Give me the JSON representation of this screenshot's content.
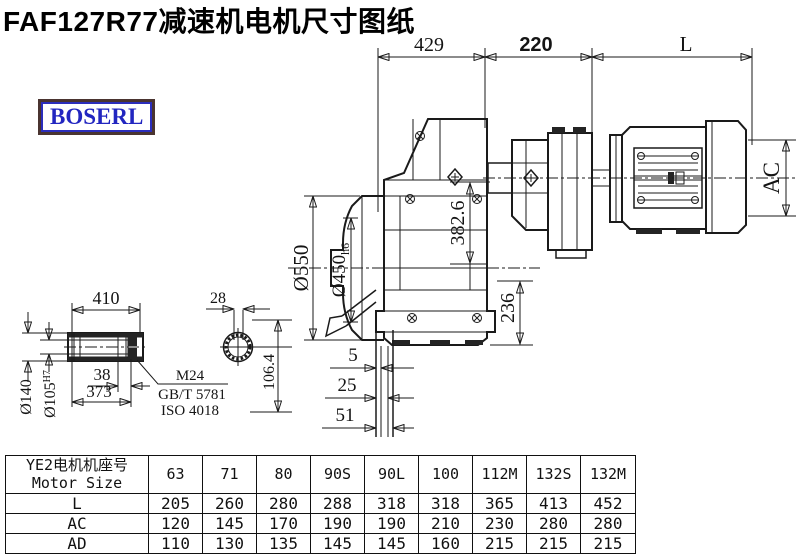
{
  "title": "FAF127R77减速机电机尺寸图纸",
  "brand": "BOSERL",
  "colors": {
    "line": "#1a1a1a",
    "brand_text": "#2226c0",
    "brand_border": "#4a3430"
  },
  "dims": {
    "top429": "429",
    "top220": "220",
    "topL": "L",
    "dia550": "Ø550",
    "dia450": "Ø450",
    "dia450_tol": "h6",
    "v382": "382.6",
    "v236": "236",
    "ac": "AC",
    "s5": "5",
    "s25": "25",
    "s51": "51",
    "shaft410": "410",
    "dia140": "Ø140",
    "dia105": "Ø105",
    "dia105_tol": "H7",
    "k38": "38",
    "k373": "373",
    "thread": "M24",
    "std_gb": "GB/T 5781",
    "std_iso": "ISO 4018",
    "c28": "28",
    "c106": "106.4"
  },
  "table": {
    "header_line1": "YE2电机机座号",
    "header_line2": "Motor Size",
    "columns": [
      "63",
      "71",
      "80",
      "90S",
      "90L",
      "100",
      "112M",
      "132S",
      "132M"
    ],
    "rows": [
      {
        "label": "L",
        "values": [
          "205",
          "260",
          "280",
          "288",
          "318",
          "318",
          "365",
          "413",
          "452"
        ]
      },
      {
        "label": "AC",
        "values": [
          "120",
          "145",
          "170",
          "190",
          "190",
          "210",
          "230",
          "280",
          "280"
        ]
      },
      {
        "label": "AD",
        "values": [
          "110",
          "130",
          "135",
          "145",
          "145",
          "160",
          "215",
          "215",
          "215"
        ]
      }
    ]
  }
}
